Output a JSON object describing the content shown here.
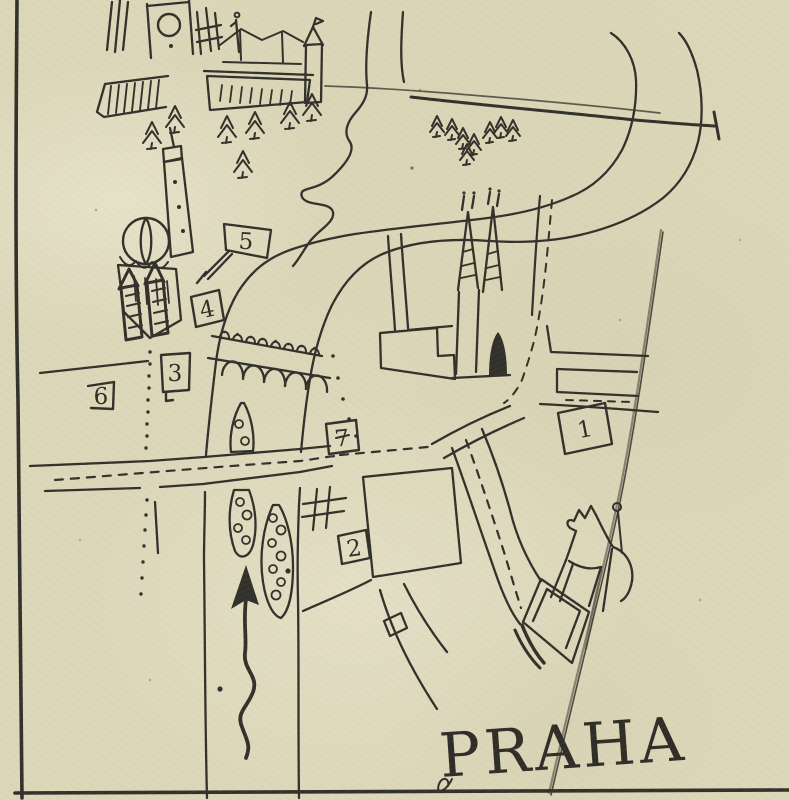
{
  "map": {
    "title": "PRAHA",
    "markers": [
      {
        "number": "1"
      },
      {
        "number": "2"
      },
      {
        "number": "3"
      },
      {
        "number": "4"
      },
      {
        "number": "5"
      },
      {
        "number": "6"
      },
      {
        "number": "7"
      }
    ],
    "colors": {
      "paper": "#dcd7b9",
      "ink": "#32302a",
      "crease_shadow": "#b4aa8c",
      "crease_highlight": "#e8e2c8"
    },
    "icons": [
      "pine-tree-icon",
      "flag-marker-icon",
      "numbered-box-icon",
      "north-arrow-icon",
      "castle-icon",
      "church-dome-icon",
      "twin-spire-church-icon",
      "bridge-with-statues-icon",
      "island-with-trees-icon",
      "equestrian-statue-icon",
      "river-icon",
      "dashed-route-icon"
    ]
  }
}
